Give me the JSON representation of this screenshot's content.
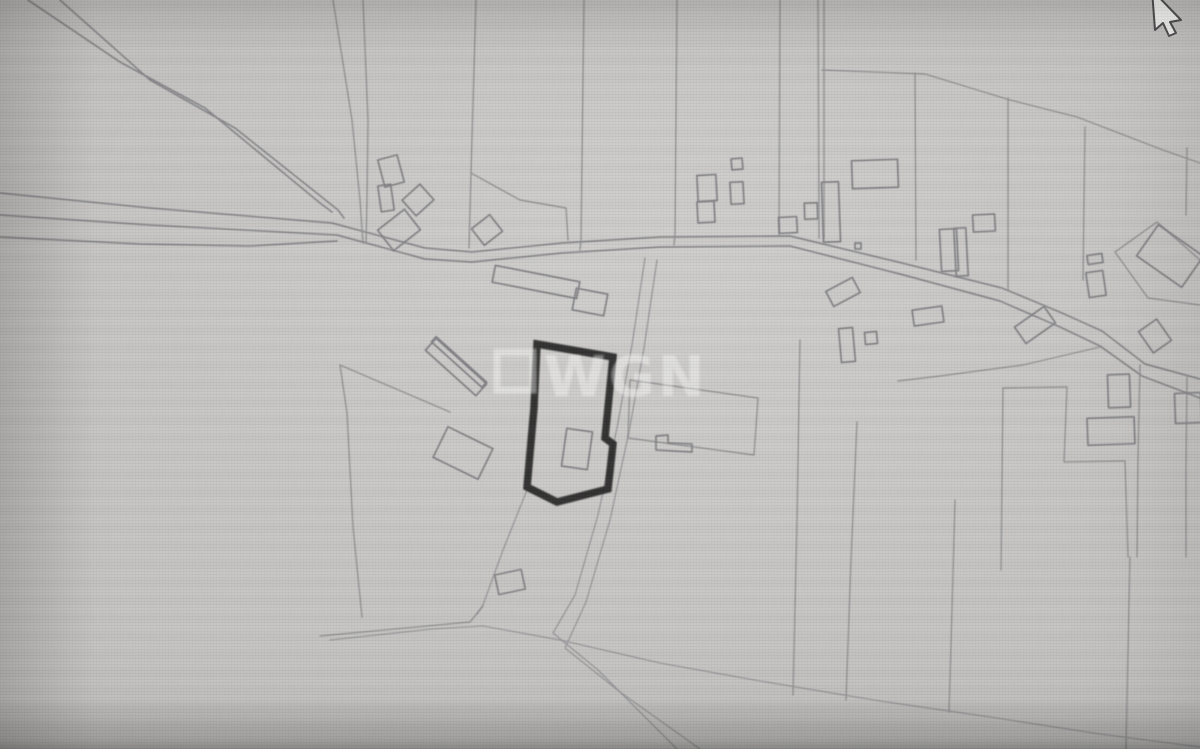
{
  "watermark": {
    "text": "WGN",
    "square": {
      "x": 497,
      "y": 352,
      "w": 36,
      "h": 38
    },
    "text_pos": {
      "x": 544,
      "y": 396
    }
  },
  "colors": {
    "background": "#c4c3c1",
    "map_line": "#8e8e90",
    "highlight_outline": "#1d1d1d",
    "watermark": "#ffffff",
    "cursor_fill": "#f6f6f5",
    "cursor_outline": "#4c4c4e"
  },
  "cursor": {
    "points": "1152,-10 1155,30 1163,23 1169,36 1176,33 1170,22 1181,20"
  },
  "map": {
    "highlight_parcel": {
      "points": "537,344 613,357 605,438 613,444 608,489 557,502 527,487 534,408"
    },
    "lines": [
      {
        "kind": "road",
        "pts": "28,0 120,62 205,108 320,203 332,212"
      },
      {
        "kind": "road",
        "pts": "60,0 150,80 235,128 338,210 344,218"
      },
      {
        "kind": "road",
        "pts": "0,193 150,208 332,223 425,248 472,252 562,243 660,237 790,236 902,263 1002,288 1062,313 1102,331 1145,364 1200,379"
      },
      {
        "kind": "road",
        "pts": "0,215 150,225 337,235 425,259 472,262 562,253 660,247 790,246 900,274 1000,301 1060,327 1100,346 1142,376 1200,398"
      },
      {
        "kind": "road",
        "pts": "0,237 140,244 250,246 337,241"
      },
      {
        "kind": "boundary",
        "pts": "333,0 352,120 360,200 363,243"
      },
      {
        "kind": "boundary",
        "pts": "363,0 368,120 367,200 366,243"
      },
      {
        "kind": "boundary",
        "pts": "476,0 471,173 469,248"
      },
      {
        "kind": "boundary",
        "pts": "584,0 581,240 580,250"
      },
      {
        "kind": "boundary",
        "pts": "677,0 675,235 674,245"
      },
      {
        "kind": "boundary",
        "pts": "780,0 779,236"
      },
      {
        "kind": "boundary",
        "pts": "818,0 819,238"
      },
      {
        "kind": "boundary",
        "pts": "824,0 824,238"
      },
      {
        "kind": "boundary",
        "pts": "822,70 925,74 1010,100 1077,117 1163,150 1200,163"
      },
      {
        "kind": "boundary",
        "pts": "915,73 916,260"
      },
      {
        "kind": "boundary",
        "pts": "1008,98 1008,290"
      },
      {
        "kind": "boundary",
        "pts": "1085,127 1083,280"
      },
      {
        "kind": "boundary",
        "pts": "1187,148 1186,215"
      },
      {
        "kind": "boundary",
        "pts": "471,173 520,200 566,208 568,240"
      },
      {
        "kind": "boundary",
        "pts": "450,412 340,365 347,413 353,527 362,617"
      },
      {
        "kind": "boundary",
        "pts": "320,636 470,622 483,606"
      },
      {
        "kind": "boundary",
        "pts": "1100,347 1023,365 940,376 898,381"
      },
      {
        "kind": "boundary",
        "pts": "800,340 797,520 793,695"
      },
      {
        "kind": "boundary",
        "pts": "857,422 851,560 846,700"
      },
      {
        "kind": "boundary",
        "pts": "955,500 952,610 949,712"
      },
      {
        "kind": "boundary",
        "pts": "1130,557 1128,650 1126,749"
      },
      {
        "kind": "boundary",
        "pts": "1003,388 1067,387 1064,462 1125,461 1128,557"
      },
      {
        "kind": "boundary",
        "pts": "1003,388 1001,570"
      },
      {
        "kind": "boundary",
        "pts": "1140,365 1138,460 1137,557"
      },
      {
        "kind": "boundary",
        "pts": "1187,377 1186,470 1186,557"
      },
      {
        "kind": "boundary",
        "pts": "630,380 758,398 754,455 628,438 630,380"
      },
      {
        "kind": "boundary",
        "pts": "1115,252 1157,222 1200,260"
      },
      {
        "kind": "boundary",
        "pts": "1115,252 1148,298 1200,305"
      },
      {
        "kind": "track",
        "pts": "527,490 503,550 483,605 477,614"
      },
      {
        "kind": "track",
        "pts": "645,258 632,345 617,428 598,515 575,595 553,633 598,670 677,749"
      },
      {
        "kind": "track",
        "pts": "657,260 644,348 629,432 610,520 586,602 565,648 620,692 700,749"
      },
      {
        "kind": "track",
        "pts": "330,640 432,629 483,626 560,640 660,663 760,681 880,701 990,717 1100,734 1200,747"
      }
    ],
    "buildings": [
      {
        "cx": 391,
        "cy": 171,
        "w": 20,
        "h": 28,
        "r": -15
      },
      {
        "cx": 386,
        "cy": 198,
        "w": 13,
        "h": 26,
        "r": -8
      },
      {
        "cx": 418,
        "cy": 200,
        "w": 24,
        "h": 21,
        "r": -42
      },
      {
        "cx": 399,
        "cy": 230,
        "w": 34,
        "h": 26,
        "r": -38
      },
      {
        "cx": 487,
        "cy": 230,
        "w": 23,
        "h": 21,
        "r": -38
      },
      {
        "cx": 536,
        "cy": 282,
        "w": 86,
        "h": 17,
        "r": 11
      },
      {
        "cx": 590,
        "cy": 302,
        "w": 32,
        "h": 22,
        "r": 11
      },
      {
        "cx": 707,
        "cy": 188,
        "w": 19,
        "h": 26,
        "r": -3
      },
      {
        "cx": 706,
        "cy": 212,
        "w": 17,
        "h": 21,
        "r": -3
      },
      {
        "cx": 737,
        "cy": 164,
        "w": 11,
        "h": 11,
        "r": -5
      },
      {
        "cx": 737,
        "cy": 193,
        "w": 13,
        "h": 22,
        "r": -3
      },
      {
        "cx": 788,
        "cy": 225,
        "w": 18,
        "h": 16,
        "r": -3
      },
      {
        "cx": 875,
        "cy": 174,
        "w": 46,
        "h": 28,
        "r": -2
      },
      {
        "cx": 831,
        "cy": 212,
        "w": 17,
        "h": 60,
        "r": -2
      },
      {
        "cx": 811,
        "cy": 211,
        "w": 13,
        "h": 16,
        "r": -2
      },
      {
        "cx": 858,
        "cy": 246,
        "w": 6,
        "h": 6,
        "r": 0
      },
      {
        "cx": 984,
        "cy": 223,
        "w": 22,
        "h": 17,
        "r": -3
      },
      {
        "cx": 949,
        "cy": 250,
        "w": 17,
        "h": 42,
        "r": -3
      },
      {
        "cx": 961,
        "cy": 252,
        "w": 12,
        "h": 48,
        "r": -3
      },
      {
        "cx": 1095,
        "cy": 259,
        "w": 15,
        "h": 9,
        "r": -8
      },
      {
        "cx": 1096,
        "cy": 284,
        "w": 17,
        "h": 25,
        "r": -8
      },
      {
        "cx": 1170,
        "cy": 256,
        "w": 55,
        "h": 38,
        "r": 35
      },
      {
        "cx": 843,
        "cy": 292,
        "w": 30,
        "h": 17,
        "r": -28
      },
      {
        "cx": 847,
        "cy": 345,
        "w": 14,
        "h": 34,
        "r": -5
      },
      {
        "cx": 871,
        "cy": 338,
        "w": 12,
        "h": 12,
        "r": -5
      },
      {
        "cx": 928,
        "cy": 316,
        "w": 30,
        "h": 16,
        "r": -8
      },
      {
        "cx": 1035,
        "cy": 325,
        "w": 36,
        "h": 20,
        "r": -35
      },
      {
        "cx": 1155,
        "cy": 336,
        "w": 22,
        "h": 26,
        "r": -35
      },
      {
        "cx": 1119,
        "cy": 391,
        "w": 22,
        "h": 33,
        "r": -2
      },
      {
        "cx": 1111,
        "cy": 431,
        "w": 47,
        "h": 27,
        "r": -2
      },
      {
        "cx": 1188,
        "cy": 408,
        "w": 26,
        "h": 30,
        "r": -2
      },
      {
        "cx": 510,
        "cy": 582,
        "w": 27,
        "h": 20,
        "r": -12
      },
      {
        "cx": 463,
        "cy": 453,
        "w": 50,
        "h": 34,
        "r": 26
      },
      {
        "cx": 456,
        "cy": 367,
        "w": 68,
        "h": 16,
        "r": 42
      },
      {
        "cx": 459,
        "cy": 362,
        "w": 68,
        "h": 7,
        "r": 42
      },
      {
        "cx": 577,
        "cy": 449,
        "w": 26,
        "h": 38,
        "r": 8
      }
    ],
    "buildings_poly": [
      {
        "pts": "656,436 668,435 668,443 692,444 692,452 656,450 656,436"
      }
    ]
  }
}
